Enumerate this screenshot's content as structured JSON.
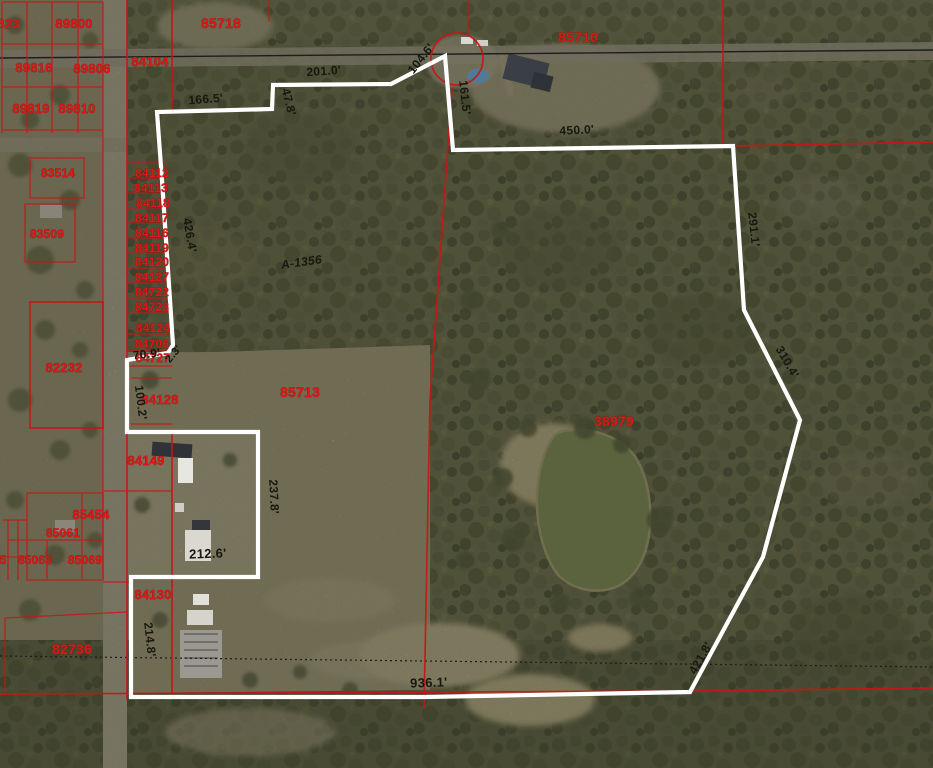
{
  "map": {
    "kind": "aerial-parcel-map",
    "colors": {
      "parcel_line": "#c51717",
      "parcel_label": "#df1715",
      "dimension_label": "#181810",
      "highlight_boundary": "#ffffff",
      "pond": "#7d8e55",
      "field": "#a8a083",
      "woods": "#666a4a",
      "road": "#b6ae9c"
    },
    "parcel_labels": [
      {
        "text": "89823",
        "x": 1,
        "y": 28,
        "size": 13
      },
      {
        "text": "89800",
        "x": 74,
        "y": 28,
        "size": 13
      },
      {
        "text": "89816",
        "x": 34,
        "y": 72,
        "size": 13
      },
      {
        "text": "89806",
        "x": 92,
        "y": 73,
        "size": 13
      },
      {
        "text": "89819",
        "x": 31,
        "y": 113,
        "size": 13
      },
      {
        "text": "89810",
        "x": 77,
        "y": 113,
        "size": 13
      },
      {
        "text": "84104",
        "x": 150,
        "y": 66,
        "size": 13
      },
      {
        "text": "85718",
        "x": 221,
        "y": 28,
        "size": 14
      },
      {
        "text": "85710",
        "x": 578,
        "y": 42,
        "size": 14
      },
      {
        "text": "83514",
        "x": 58,
        "y": 177,
        "size": 12
      },
      {
        "text": "83509",
        "x": 47,
        "y": 238,
        "size": 12
      },
      {
        "text": "84112",
        "x": 152,
        "y": 177,
        "size": 12
      },
      {
        "text": "84113",
        "x": 151,
        "y": 192,
        "size": 12
      },
      {
        "text": "84118",
        "x": 153,
        "y": 207,
        "size": 12
      },
      {
        "text": "84117",
        "x": 152,
        "y": 222,
        "size": 12
      },
      {
        "text": "84116",
        "x": 152,
        "y": 237,
        "size": 12
      },
      {
        "text": "84119",
        "x": 152,
        "y": 252,
        "size": 12
      },
      {
        "text": "84120",
        "x": 152,
        "y": 266,
        "size": 12
      },
      {
        "text": "84127",
        "x": 152,
        "y": 281,
        "size": 12
      },
      {
        "text": "84722",
        "x": 152,
        "y": 296,
        "size": 12
      },
      {
        "text": "84723",
        "x": 152,
        "y": 311,
        "size": 12
      },
      {
        "text": "84124",
        "x": 153,
        "y": 332,
        "size": 12
      },
      {
        "text": "84706",
        "x": 152,
        "y": 348,
        "size": 12
      },
      {
        "text": "84727",
        "x": 153,
        "y": 362,
        "size": 12
      },
      {
        "text": "82232",
        "x": 64,
        "y": 372,
        "size": 13
      },
      {
        "text": "84128",
        "x": 160,
        "y": 404,
        "size": 13
      },
      {
        "text": "84149",
        "x": 146,
        "y": 465,
        "size": 13
      },
      {
        "text": "85454",
        "x": 91,
        "y": 519,
        "size": 13
      },
      {
        "text": "85061",
        "x": 63,
        "y": 537,
        "size": 12
      },
      {
        "text": "85063",
        "x": 35,
        "y": 564,
        "size": 12
      },
      {
        "text": "85069",
        "x": 85,
        "y": 564,
        "size": 12
      },
      {
        "text": "5",
        "x": 3,
        "y": 564,
        "size": 12
      },
      {
        "text": "84130",
        "x": 153,
        "y": 599,
        "size": 13
      },
      {
        "text": "82736",
        "x": 72,
        "y": 654,
        "size": 14
      },
      {
        "text": "85713",
        "x": 300,
        "y": 397,
        "size": 14
      },
      {
        "text": "38979",
        "x": 614,
        "y": 426,
        "size": 14
      }
    ],
    "dimension_labels": [
      {
        "text": "201.0'",
        "x": 324,
        "y": 75,
        "rot": -4,
        "size": 12
      },
      {
        "text": "166.5'",
        "x": 206,
        "y": 103,
        "rot": -4,
        "size": 12
      },
      {
        "text": "47.8'",
        "x": 285,
        "y": 103,
        "rot": 76,
        "size": 12
      },
      {
        "text": "104.6'",
        "x": 424,
        "y": 61,
        "rot": -52,
        "size": 12
      },
      {
        "text": "161.5'",
        "x": 461,
        "y": 98,
        "rot": 84,
        "size": 12
      },
      {
        "text": "450.0'",
        "x": 577,
        "y": 134,
        "rot": -3,
        "size": 12
      },
      {
        "text": "426.4'",
        "x": 186,
        "y": 236,
        "rot": 80,
        "size": 12
      },
      {
        "text": "A-1356",
        "x": 302,
        "y": 266,
        "rot": -8,
        "size": 12,
        "style": "abstract"
      },
      {
        "text": "291.1'",
        "x": 750,
        "y": 230,
        "rot": 84,
        "size": 12
      },
      {
        "text": "310.4'",
        "x": 784,
        "y": 364,
        "rot": 60,
        "size": 12
      },
      {
        "text": "70.9'",
        "x": 147,
        "y": 358,
        "rot": -6,
        "size": 12
      },
      {
        "text": "2.3'",
        "x": 176,
        "y": 356,
        "rot": -50,
        "size": 11
      },
      {
        "text": "100.2'",
        "x": 137,
        "y": 403,
        "rot": 83,
        "size": 12
      },
      {
        "text": "237.8'",
        "x": 270,
        "y": 497,
        "rot": 87,
        "size": 12
      },
      {
        "text": "212.6'",
        "x": 208,
        "y": 558,
        "rot": -2,
        "size": 13
      },
      {
        "text": "214.8'",
        "x": 146,
        "y": 640,
        "rot": 84,
        "size": 12
      },
      {
        "text": "936.1'",
        "x": 429,
        "y": 687,
        "rot": -2,
        "size": 13
      },
      {
        "text": "421.8'",
        "x": 704,
        "y": 660,
        "rot": -60,
        "size": 12
      }
    ]
  }
}
